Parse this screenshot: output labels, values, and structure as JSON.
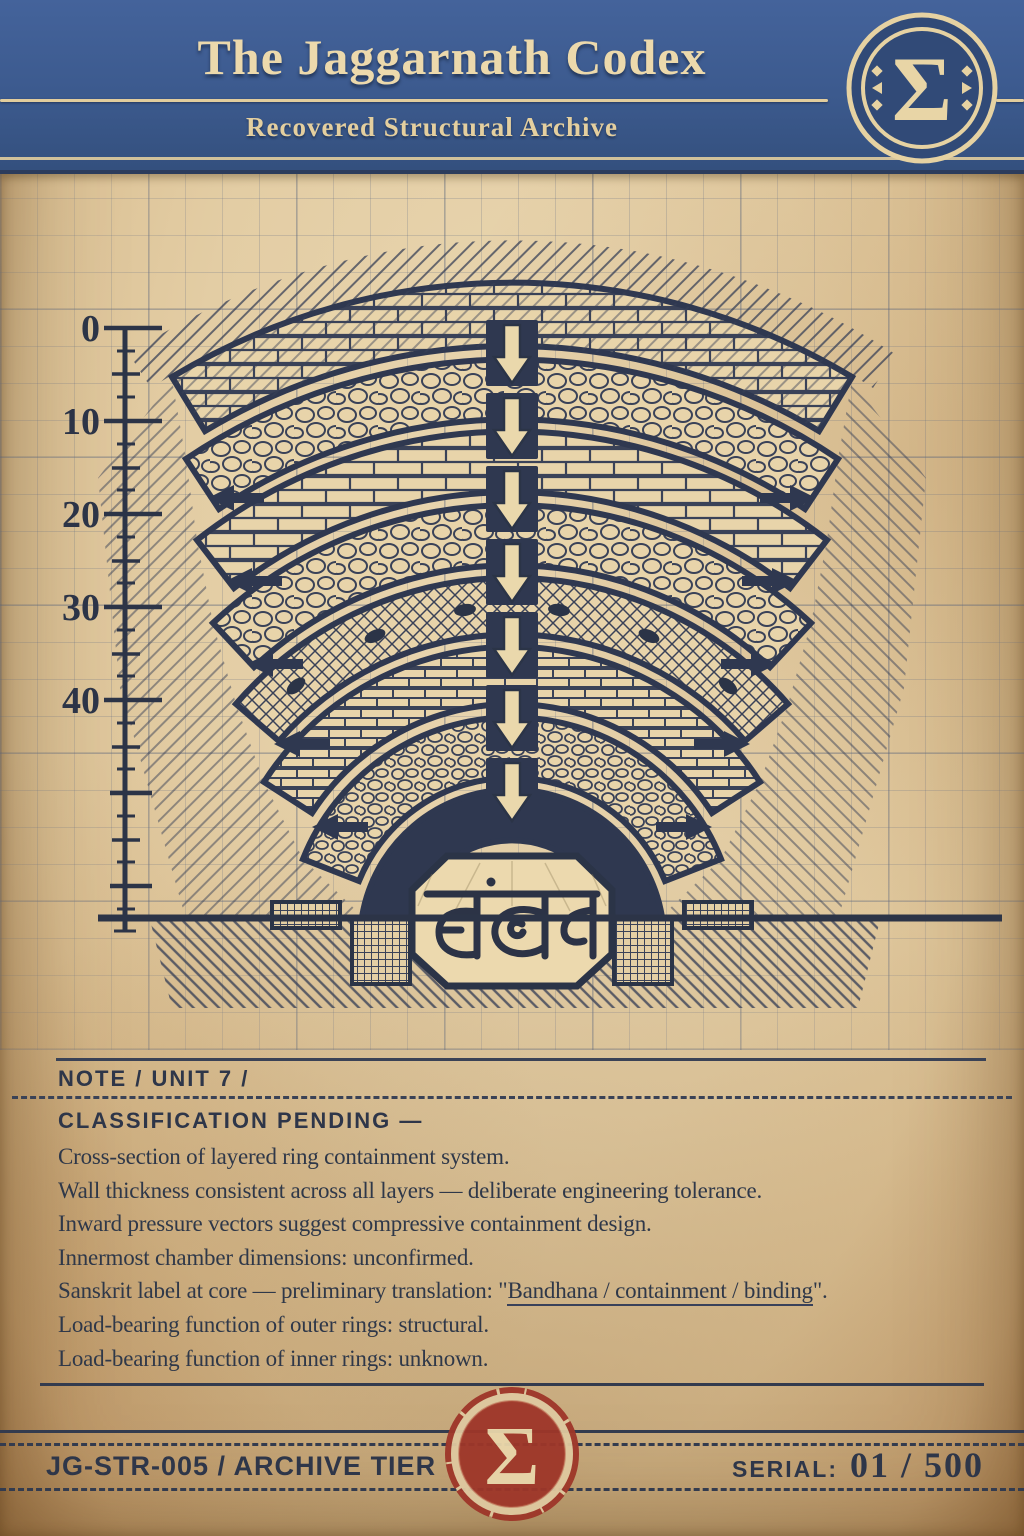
{
  "header": {
    "title": "The Jaggarnath Codex",
    "subtitle": "Recovered Structural Archive",
    "badge_symbol": "Σ"
  },
  "diagram": {
    "scale_ticks": [
      "0",
      "10",
      "20",
      "30",
      "40"
    ],
    "core_label": "बंधन"
  },
  "note": {
    "heading": "NOTE / UNIT 7 /",
    "classification": "CLASSIFICATION PENDING —",
    "lines": [
      "Cross-section of layered ring containment system.",
      "Wall thickness consistent across all layers — deliberate engineering tolerance.",
      "Inward pressure vectors suggest compressive containment design.",
      "Innermost chamber dimensions: unconfirmed."
    ],
    "sanskrit_line": {
      "prefix": "Sanskrit label at core — preliminary translation: \"",
      "underlined": "Bandhana / containment / binding",
      "suffix": "\"."
    },
    "lines2": [
      "Load-bearing function of outer rings: structural.",
      "Load-bearing function of inner rings: unknown."
    ]
  },
  "footer": {
    "catalog": "JG-STR-005 / ARCHIVE TIER",
    "serial_label": "SERIAL:",
    "serial_value": "01 / 500",
    "stamp_symbol": "Σ"
  },
  "colors": {
    "header_blue": "#3c5a8e",
    "paper": "#e3cda4",
    "ink": "#2d3448",
    "cream": "#ecd9ac",
    "stamp_red": "#9e3629"
  }
}
